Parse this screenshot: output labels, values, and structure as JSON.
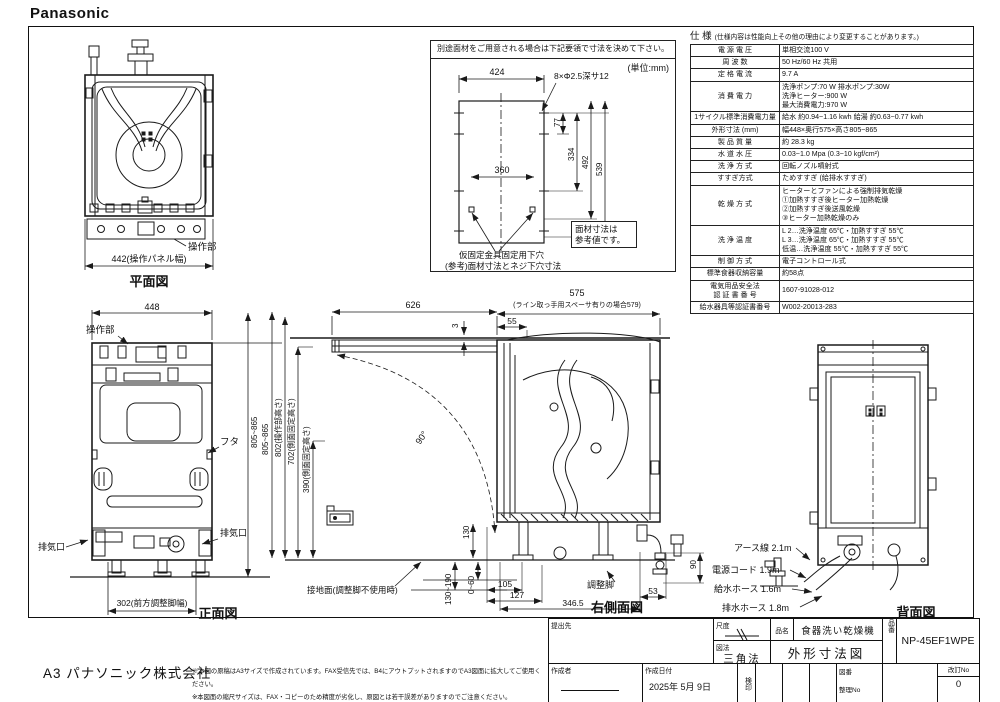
{
  "brand": "Panasonic",
  "plan_view": {
    "title": "平面図",
    "control_label": "操作部",
    "width_dim": "442(操作パネル幅)"
  },
  "panel_template": {
    "heading": "別途面材をご用意される場合は下記要領で寸法を決めて下さい。",
    "unit": "(単位:mm)",
    "dim_424": "424",
    "hole_note": "8×Φ2.5深サ12",
    "dim_77": "77",
    "dim_334": "334",
    "dim_492": "492",
    "dim_539": "539",
    "dim_360": "360",
    "pilot_label_1": "仮固定金具固定用下穴",
    "pilot_label_2": "(参考)面材寸法とネジ下穴寸法",
    "ref_note": "面材寸法は\n参考値です。"
  },
  "spec_table": {
    "heading": "仕 様",
    "heading_note": "(仕様内容は性能向上その他の理由により変更することがあります。)",
    "rows": [
      {
        "label": "電 源 電 圧",
        "value": "単相交流100 V"
      },
      {
        "label": "周 波 数",
        "value": "50 Hz/60 Hz 共用"
      },
      {
        "label": "定 格 電 流",
        "value": "9.7 A"
      },
      {
        "label": "消 費 電 力",
        "value": "洗浄ポンプ:70 W  排水ポンプ:30W\n洗浄ヒーター:900 W\n最大消費電力:970 W"
      },
      {
        "label": "1サイクル標準消費電力量",
        "value": "給水 約0.94~1.16 kwh 給湯 約0.63~0.77 kwh"
      },
      {
        "label": "外形寸法 (mm)",
        "value": "幅448×奥行575×高さ805~865"
      },
      {
        "label": "製 品 質 量",
        "value": "約 28.3 kg"
      },
      {
        "label": "水 道 水 圧",
        "value": "0.03~1.0 Mpa (0.3~10 kgf/cm²)"
      },
      {
        "label": "洗 浄 方 式",
        "value": "回転ノズル噴射式"
      },
      {
        "label": "すすぎ方式",
        "value": "ためすすぎ (給排水すすぎ)"
      },
      {
        "label": "乾 燥 方 式",
        "value": "ヒーターとファンによる強制排気乾燥\n①加熱すすぎ後ヒーター加熱乾燥\n②加熱すすぎ後送風乾燥\n③ヒーター加熱乾燥のみ"
      },
      {
        "label": "洗 浄 温 度",
        "value": "L 2…洗浄温度 65℃・加熱すすぎ 55℃\nL 3…洗浄温度 65℃・加熱すすぎ 55℃\n低温…洗浄温度 55℃・加熱すすぎ 55℃"
      },
      {
        "label": "制 御 方 式",
        "value": "電子コントロール式"
      },
      {
        "label": "標準食器収納容量",
        "value": "約58点"
      },
      {
        "label": "電気用品安全法\n認 証 書 番 号",
        "value": "1607-91028-012"
      },
      {
        "label": "給水器具等認証書番号",
        "value": "W002-20013-283"
      }
    ]
  },
  "front_view": {
    "title": "正面図",
    "dim_width": "448",
    "control_label": "操作部",
    "lid_label": "フタ",
    "dim_height": "805~865",
    "vent_left": "排気口",
    "vent_right": "排気口",
    "dim_feet": "302(前方調整脚幅)"
  },
  "side_view": {
    "title": "右側面図",
    "dim_626": "626",
    "dim_3": "3",
    "dim_55": "55",
    "dim_575": "575",
    "dim_575_note": "(ライン取っ手用スペーサ有りの場合579)",
    "angle": "90°",
    "dim_height": "805~865",
    "dim_802": "802(操作部高さ)",
    "dim_702": "702(側面固定高さ)",
    "dim_390": "390(側面固定高さ)",
    "dim_130": "130",
    "dim_0_60": "0~60",
    "dim_130_190": "130~190",
    "dim_105": "105",
    "dim_127": "127",
    "dim_346_5": "346.5",
    "dim_53": "53",
    "dim_90": "90",
    "foot_label": "調整脚",
    "ground_label": "接地面(調整脚不使用時)"
  },
  "back_view": {
    "title": "背面図",
    "earth_label": "アース線 2.1m",
    "cord_label": "電源コード 1.9m",
    "supply_label": "給水ホース 1.6m",
    "drain_label": "排水ホース 1.8m"
  },
  "title_block": {
    "dest_label": "提出先",
    "scale_label": "尺度",
    "projection_label": "図法",
    "projection_value": "三角法",
    "product_label": "品名",
    "product_value": "食器洗い乾燥機",
    "drawing_title": "外形寸法図",
    "model_label": "品番",
    "model_value": "NP-45EF1WPE",
    "author_label": "作成者",
    "date_label": "作成日付",
    "date_value": "2025年  5月  9日",
    "stamp_label": "検印",
    "zuban_label": "図番",
    "seiri_label": "整理No",
    "rev_label": "改訂No",
    "rev_value": "0"
  },
  "footer": {
    "company": "A3 パナソニック株式会社",
    "notes": "※本図の原稿はA3サイズで作成されています。FAX受信先では、B4にアウトプットされますのでA3図面に拡大してご使用ください。\n※本図面の縮尺サイズは、FAX・コピーのため精度が劣化し、原図とは若干誤差がありますのでご注意ください。"
  }
}
